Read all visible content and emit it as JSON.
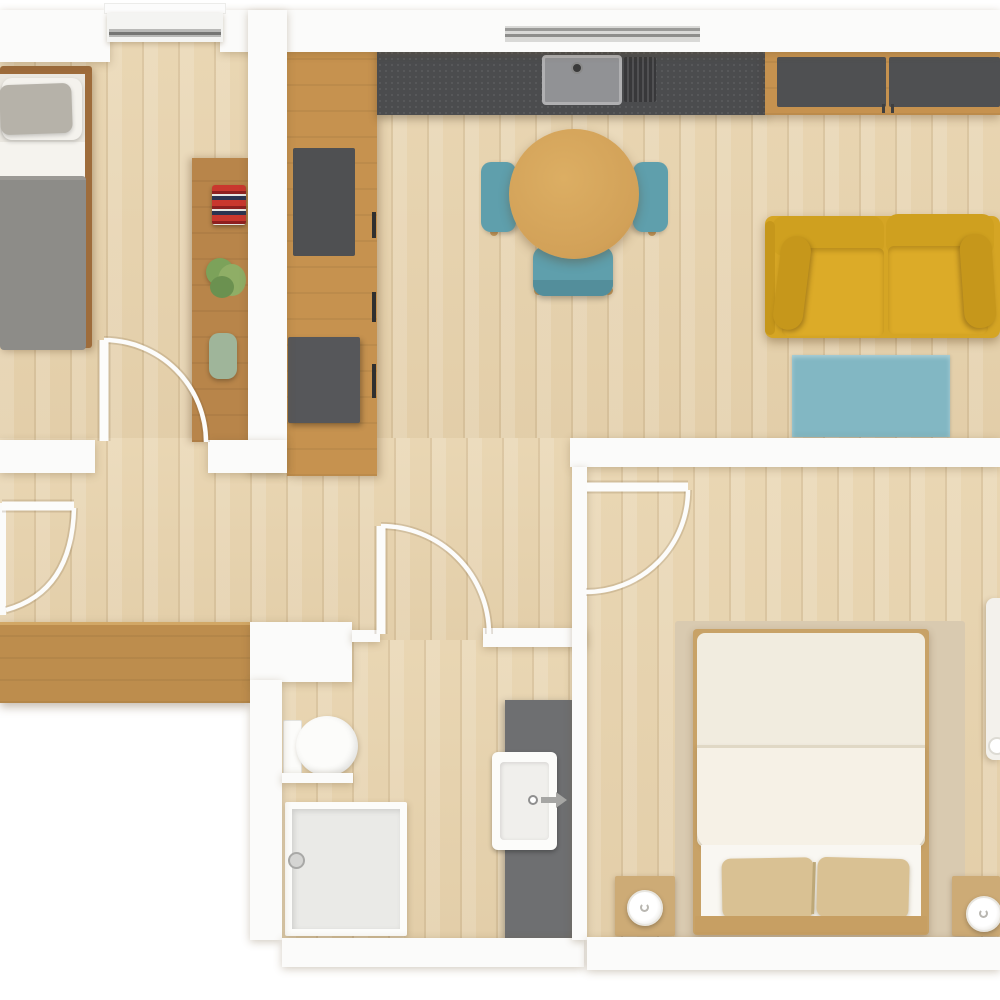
{
  "document": {
    "type": "apartment-floor-plan",
    "view": "top-down-3d-render",
    "visible_text": [],
    "rooms": [
      {
        "id": "bedroom-1",
        "position": "top-left",
        "furniture": [
          "double-bed-gray-duvet",
          "white-pillow",
          "gray-pillow",
          "desk-shelf",
          "red-striped-towels",
          "potted-plant",
          "green-vase",
          "window"
        ]
      },
      {
        "id": "kitchen",
        "position": "top-center",
        "furniture": [
          "tall-cabinet-column",
          "dark-appliance-panels",
          "dark-countertop",
          "sink-with-faucet",
          "ribbed-drainboard",
          "window",
          "round-dining-table",
          "teal-chair-left",
          "teal-chair-right",
          "teal-chair-bottom"
        ]
      },
      {
        "id": "living-room",
        "position": "top-right",
        "furniture": [
          "sideboard-dark-doors",
          "mustard-sofa",
          "teal-rug"
        ]
      },
      {
        "id": "hallway",
        "position": "middle-left",
        "furniture": [
          "entry-door",
          "wooden-console"
        ]
      },
      {
        "id": "bathroom",
        "position": "bottom-center",
        "furniture": [
          "toilet",
          "shower-enclosure",
          "gray-vanity",
          "white-sink-with-faucet",
          "door"
        ]
      },
      {
        "id": "bedroom-2",
        "position": "bottom-right",
        "furniture": [
          "double-bed-cream-duvet",
          "two-tan-pillows",
          "wood-headboard",
          "beige-area-rug",
          "nightstand-left-with-lamp",
          "nightstand-right-with-lamp",
          "white-wardrobe",
          "door"
        ]
      }
    ],
    "doors": [
      "entry-door-west",
      "bedroom-1-door",
      "bathroom-door",
      "bedroom-2-door"
    ]
  },
  "colors": {
    "outside": "#ffffff",
    "wall": "#fbfbfa",
    "floor": "#e8d4af",
    "woodCabinet": "#c6924f",
    "woodConsole": "#bd8d4d",
    "woodDesk": "#b8854a",
    "woodBedFrame": "#9e6c3b",
    "counter": "#4b4c4e",
    "darkPanel": "#4f5052",
    "table": "#d2a158",
    "chairTeal": "#5f9fac",
    "chairTealDark": "#538e9b",
    "sofa": "#d5a524",
    "sofaLight": "#dcab28",
    "sofaDark": "#c6971b",
    "rugTeal": "#82b7c3",
    "duvetGray": "#8d8c88",
    "pillowWhite": "#f4f2ed",
    "pillowGray": "#b6b2a9",
    "bedBeigeRug": "#d9cab0",
    "duvetCream": "#f1ecdf",
    "duvetFold": "#f6f1e6",
    "sheet": "#f9f7f2",
    "pillowTan": "#d9c193",
    "woodBed2": "#c8a267",
    "nightstand": "#cdab76",
    "fixtureWhite": "#fcfcfa",
    "grayFixture": "#6e6f71",
    "trayGray": "#eaeae7",
    "plantGreen": "#7ca25a",
    "vaseGreen": "#9fb59a",
    "towelRed": "#c9372e",
    "windowTrack": "#9a9a98"
  }
}
